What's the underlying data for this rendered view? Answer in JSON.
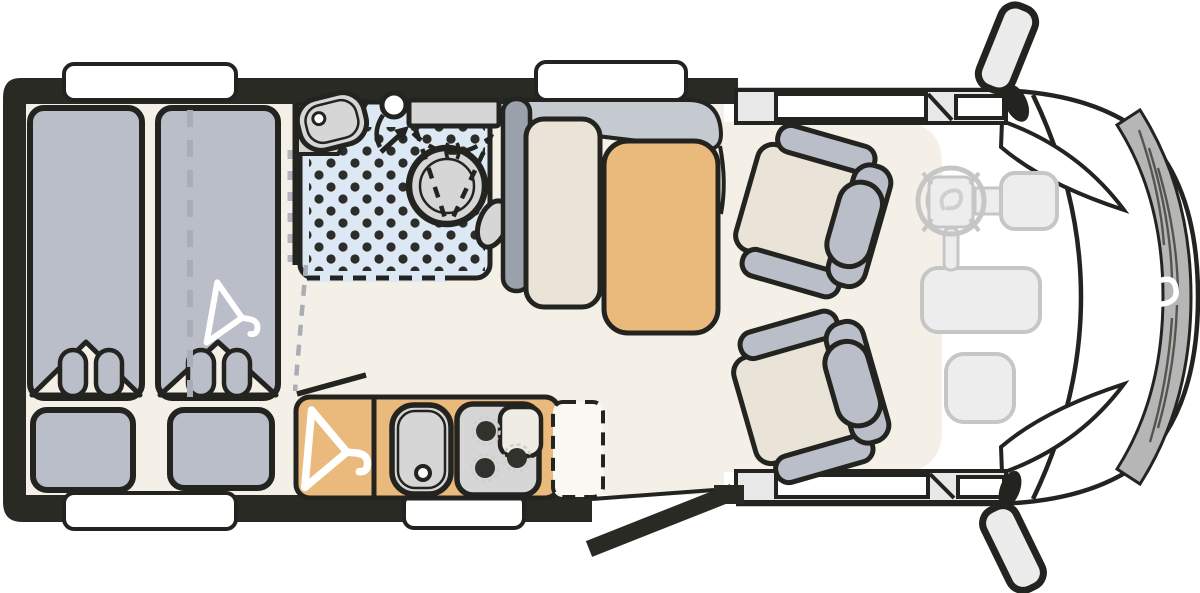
{
  "meta": {
    "image_type": "motorhome-floorplan-top-view",
    "orientation": "cab-on-right, rear-bedroom-on-left"
  },
  "colors": {
    "wall": "#2a2a25",
    "outline": "#23231f",
    "floor": "#f4f0e7",
    "upholstery": "#b9bec8",
    "cushion": "#eae4d8",
    "wood": "#eaba7c",
    "shower": "#dce8f4",
    "fixture": "#d6d6d6",
    "partition": "#9aa1ab",
    "sideboard": "#c5c9d0",
    "band": "#e8e8e8",
    "grille": "#b6b6b6",
    "ghost_fill": "#ededed",
    "ghost_line": "#c6c6c6",
    "window": "#ffffff",
    "dot": "#2c2c28",
    "counter_gray": "#d2d2d2",
    "burner": "#32322d",
    "option_fill": "#faf8f3",
    "notch": "#efece4",
    "mirror": "#ececec",
    "white": "#ffffff"
  },
  "rooms": {
    "bedroom": {
      "items": [
        "single-bed-left",
        "single-bed-right",
        "pillow-left",
        "pillow-right",
        "duvet-fold",
        "bed-divider-dashed-line",
        "hanger-icon"
      ]
    },
    "bathroom": {
      "items": [
        "washbasin",
        "faucet",
        "shower-head",
        "shower-tray-dotted-floor",
        "swivel-toilet",
        "toilet-swing-dashed-lines",
        "swivel-arrow",
        "sliding-door-dashed-line"
      ]
    },
    "kitchen": {
      "items": [
        "wardrobe-with-hanger",
        "kitchen-sink",
        "three-burner-hob",
        "optional-unit-dashed-outline"
      ]
    },
    "dinette": {
      "items": [
        "sideboard",
        "bench-backrest",
        "bench-seat",
        "table"
      ]
    },
    "cab": {
      "items": [
        "driver-seat",
        "passenger-seat",
        "steering-wheel",
        "airbag-pad",
        "center-console",
        "dashboard-tray",
        "windshield",
        "front-grille",
        "brand-logo",
        "door-mirror-top",
        "door-mirror-bottom",
        "entry-door-open",
        "entry-step",
        "cab-window-strip-top",
        "cab-window-strip-bottom"
      ]
    }
  }
}
